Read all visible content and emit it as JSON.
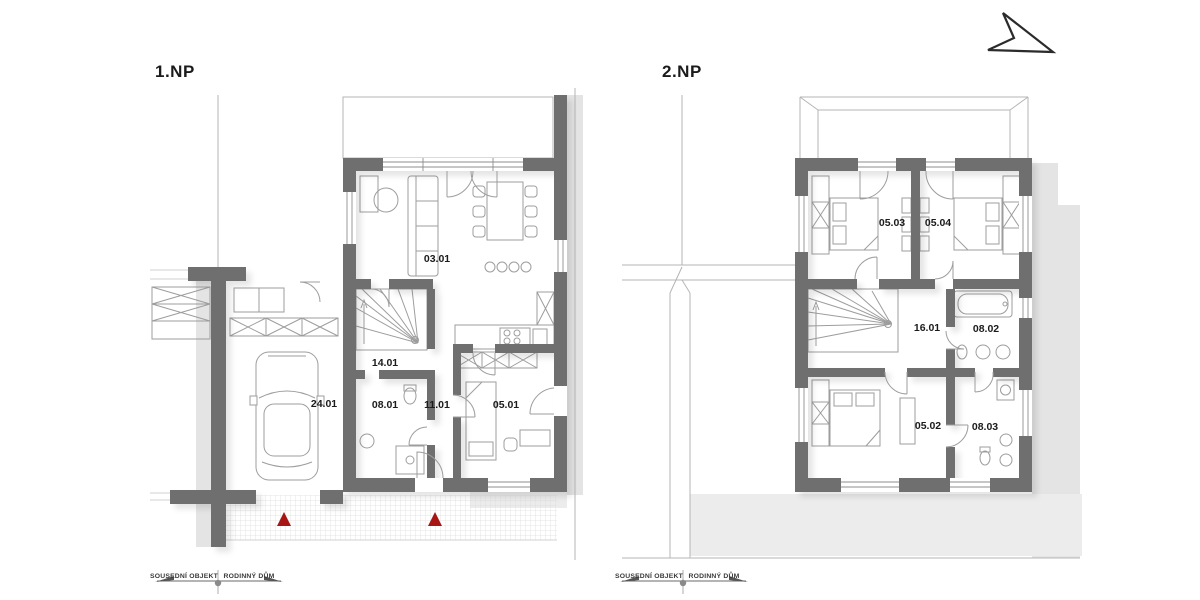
{
  "document": {
    "type": "floor-plan-drawing",
    "background": "#ffffff"
  },
  "colors": {
    "wall": "#6f6f6f",
    "shadow": "#e4e4e4",
    "thin_line": "#b5b5b5",
    "furniture_line": "#9d9d9d",
    "entrance_marker": "#a81515",
    "text": "#1b1b1b"
  },
  "compass": {
    "icon": "north-arrow"
  },
  "plans": [
    {
      "title": "1.NP",
      "rooms": [
        {
          "id": "03.01"
        },
        {
          "id": "14.01"
        },
        {
          "id": "08.01"
        },
        {
          "id": "11.01"
        },
        {
          "id": "05.01"
        },
        {
          "id": "24.01"
        }
      ],
      "markers": [
        {
          "type": "entrance-triangle"
        },
        {
          "type": "entrance-triangle"
        }
      ],
      "scale_bar": {
        "left_label": "SOUSEDNÍ OBJEKT",
        "right_label": "RODINNÝ DŮM"
      }
    },
    {
      "title": "2.NP",
      "rooms": [
        {
          "id": "05.03"
        },
        {
          "id": "05.04"
        },
        {
          "id": "16.01"
        },
        {
          "id": "08.02"
        },
        {
          "id": "05.02"
        },
        {
          "id": "08.03"
        }
      ],
      "scale_bar": {
        "left_label": "SOUSEDNÍ OBJEKT",
        "right_label": "RODINNÝ DŮM"
      }
    }
  ]
}
